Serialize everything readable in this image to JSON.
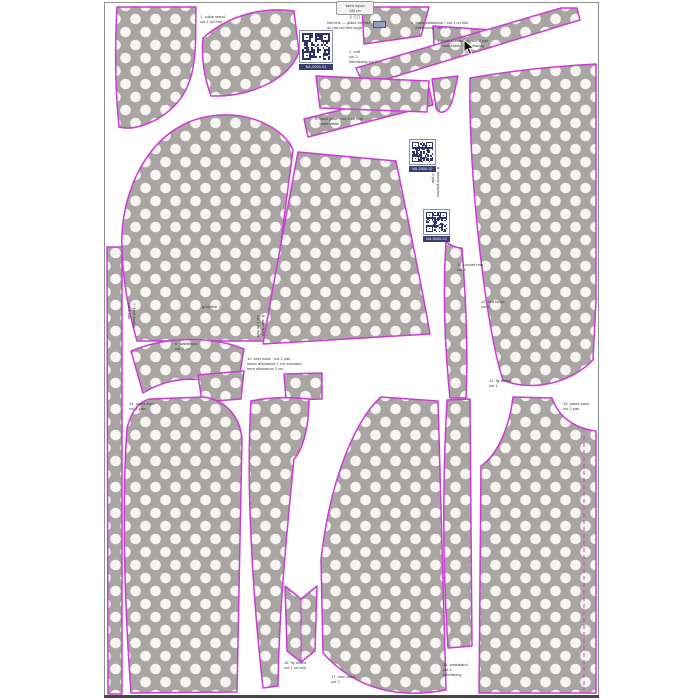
{
  "canvas": {
    "width": 700,
    "height": 700
  },
  "page": {
    "background": "#ffffff",
    "border_color": "#8f8f8f",
    "bottom_edge_color": "#474747"
  },
  "fabric": {
    "base_color": "#a8a5a2",
    "dot_color": "#f7f5f2",
    "outline_color": "#c93dd3"
  },
  "size_label": {
    "line1": "fabric layout",
    "line2": "150 cm",
    "size": "X00"
  },
  "qr_codes": [
    {
      "caption": "NA-0000-01"
    },
    {
      "caption": "NA-0000-02"
    },
    {
      "caption": "NA-0000-03"
    }
  ],
  "annotations": [
    {
      "text": "1  collar stand\ncut 1 on fold"
    },
    {
      "text": "fold line — place on fold\ndo not cut this edge"
    },
    {
      "text": "2  cuff\ncut 2\ninterfacing cut 2"
    },
    {
      "text": "3  back waistband · cut 1 on fold\n    interfacing · cut 1"
    },
    {
      "text": "4  front waistband · cut 2 pair\n    main fabric + interfacing"
    },
    {
      "text": "5  back yoke · cut 2 on fold\n    main fabric"
    },
    {
      "text": "6  sleeve placket\ncut 2 pair"
    },
    {
      "text": "7  front bodice\ncut 2 pair"
    },
    {
      "text": "grainline ↑"
    },
    {
      "text": "8  skirt front\ncut 1 on fold"
    },
    {
      "text": "9  waistband\ncut 2  ↘"
    },
    {
      "text": "10  skirt back · cut 2 pair\nseam allowance 1 cm included\nhem allowance 2 cm"
    },
    {
      "text": "11  pocket bag\ncut 4"
    },
    {
      "text": "12  belt loops\ncut 6"
    },
    {
      "text": "13  fly facing\ncut 1"
    },
    {
      "text": "14  pants front\ncut 2 pair"
    },
    {
      "text": "15  pants back\ncut 2 pair"
    },
    {
      "text": "16  fly shield\ncut 1 on fold"
    },
    {
      "text": "17  hem band\ncut 2"
    },
    {
      "text": "18  waistband\ncut 1\ninterfacing"
    }
  ]
}
